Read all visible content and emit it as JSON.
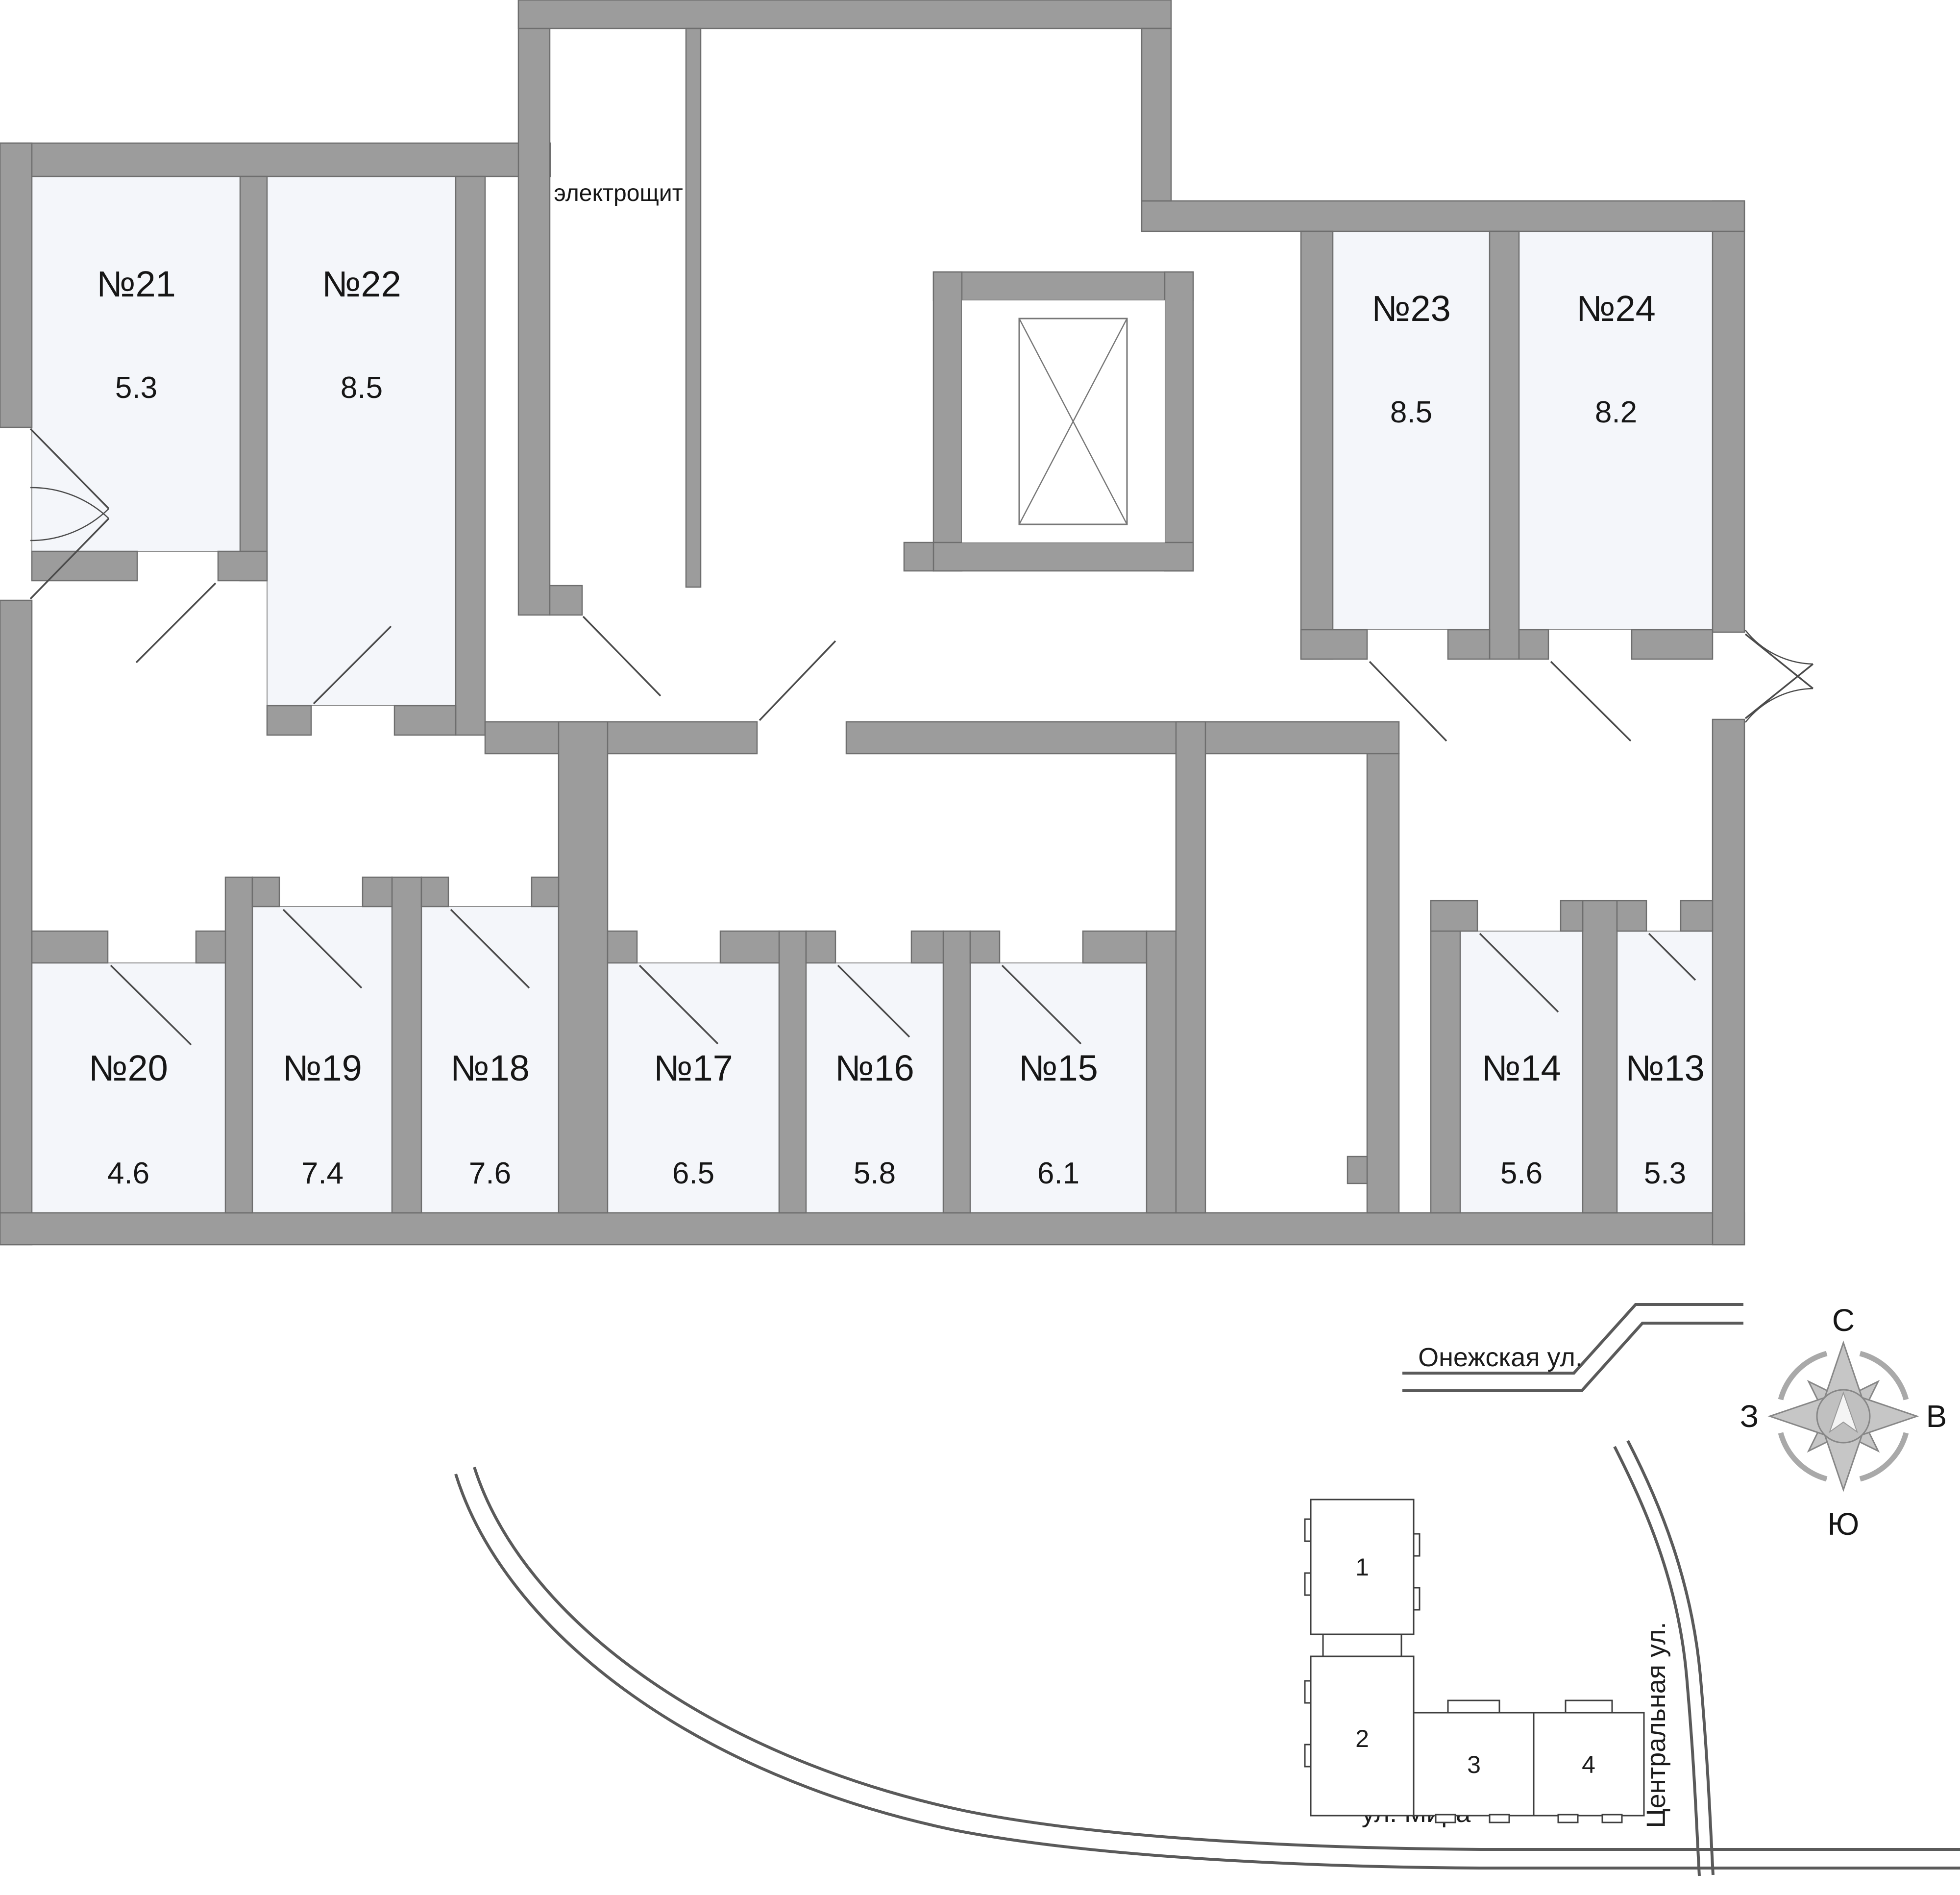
{
  "plan": {
    "electro_label": "электрощит"
  },
  "rooms": [
    {
      "number": "№21",
      "area": "5.3"
    },
    {
      "number": "№22",
      "area": "8.5"
    },
    {
      "number": "№23",
      "area": "8.5"
    },
    {
      "number": "№24",
      "area": "8.2"
    },
    {
      "number": "№20",
      "area": "4.6"
    },
    {
      "number": "№19",
      "area": "7.4"
    },
    {
      "number": "№18",
      "area": "7.6"
    },
    {
      "number": "№17",
      "area": "6.5"
    },
    {
      "number": "№16",
      "area": "5.8"
    },
    {
      "number": "№15",
      "area": "6.1"
    },
    {
      "number": "№14",
      "area": "5.6"
    },
    {
      "number": "№13",
      "area": "5.3"
    }
  ],
  "compass": {
    "north": "С",
    "south": "Ю",
    "west": "З",
    "east": "В"
  },
  "streets": {
    "onezhskaya": "Онежская ул.",
    "mira": "ул. Мира",
    "tsentralnaya": "Центральная ул."
  },
  "site_plan": {
    "sections": [
      {
        "label": "1",
        "active": false
      },
      {
        "label": "2",
        "active": false
      },
      {
        "label": "3",
        "active": true
      },
      {
        "label": "4",
        "active": false
      }
    ]
  },
  "colors": {
    "wall": "#9c9c9c",
    "room_fill": "#f4f6fa",
    "active_section": "#c8c8c8"
  }
}
